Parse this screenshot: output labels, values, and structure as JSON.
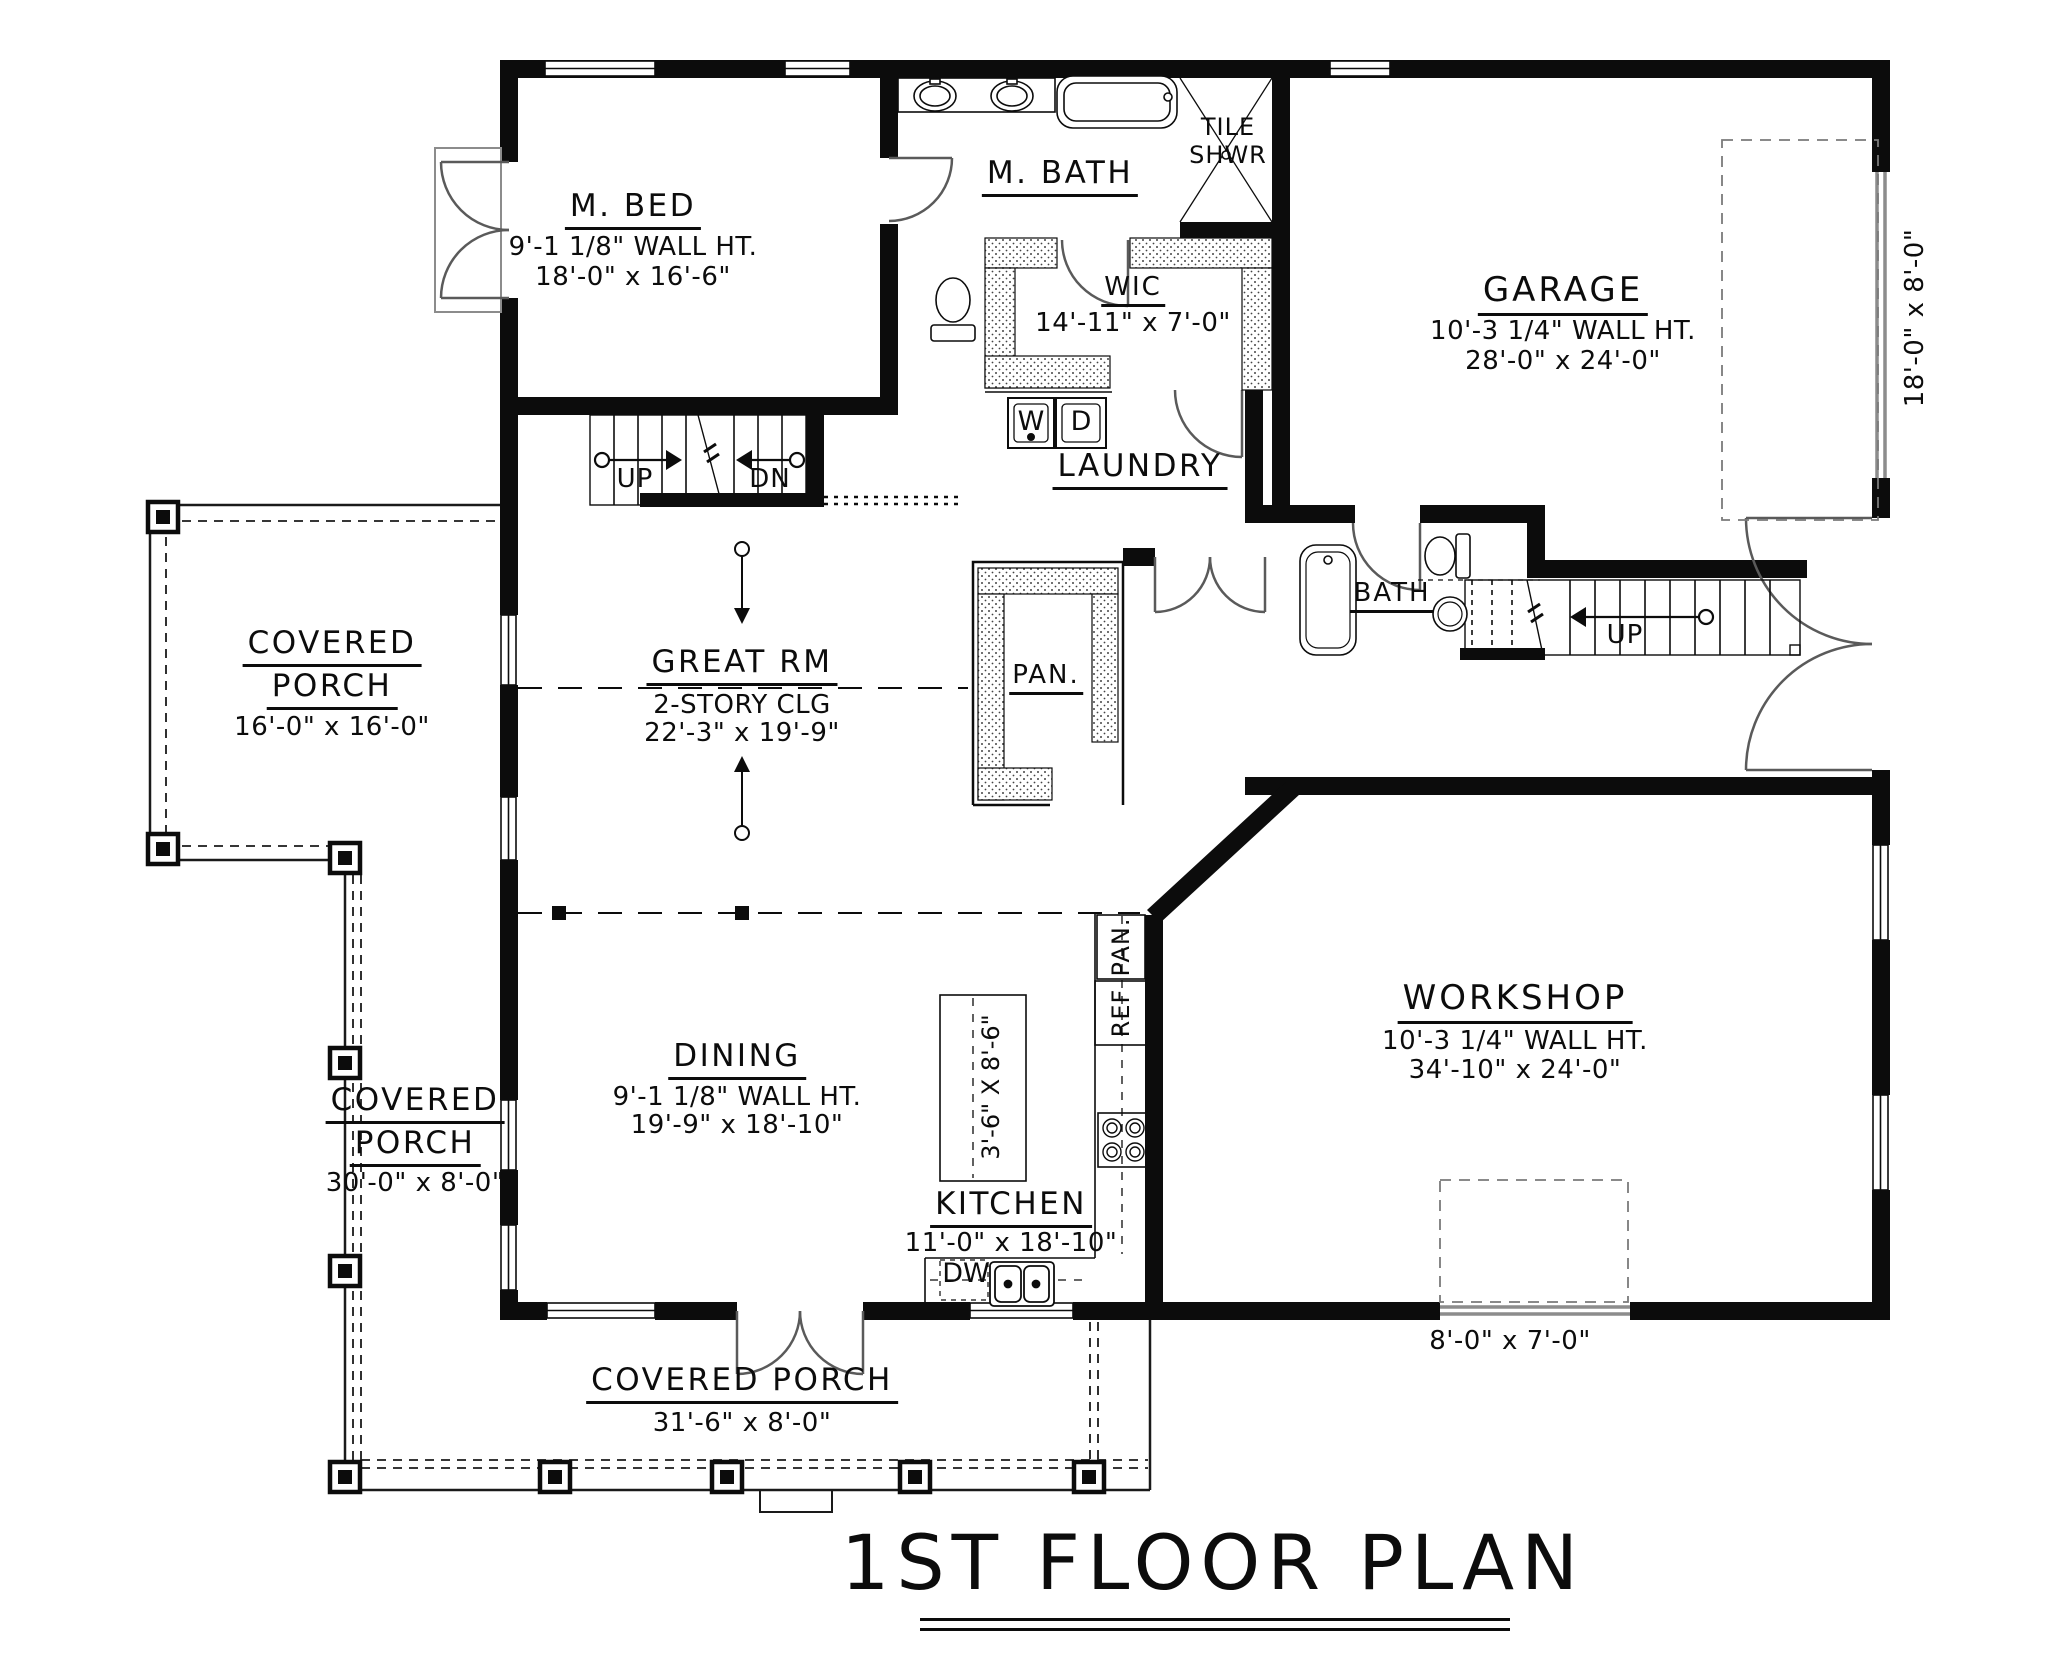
{
  "title": "1ST FLOOR PLAN",
  "rooms": {
    "m_bed": {
      "name": "M. BED",
      "wall_ht": "9'-1 1/8\" WALL HT.",
      "dims": "18'-0\" x 16'-6\""
    },
    "m_bath": {
      "name": "M. BATH"
    },
    "tile_shower": {
      "line1": "TILE",
      "line2": "SHWR"
    },
    "wic": {
      "name": "WIC",
      "dims": "14'-11\" x 7'-0\""
    },
    "garage": {
      "name": "GARAGE",
      "wall_ht": "10'-3 1/4\" WALL HT.",
      "dims": "28'-0\" x 24'-0\"",
      "door_dims": "18'-0\" x 8'-0\""
    },
    "laundry": {
      "name": "LAUNDRY"
    },
    "porch_left": {
      "name1": "COVERED",
      "name2": "PORCH",
      "dims": "16'-0\" x 16'-0\""
    },
    "great_rm": {
      "name": "GREAT RM",
      "ceiling": "2-STORY CLG",
      "dims": "22'-3\" x 19'-9\""
    },
    "pantry": {
      "name": "PAN."
    },
    "bath": {
      "name": "BATH"
    },
    "porch_side": {
      "name1": "COVERED",
      "name2": "PORCH",
      "dims": "30'-0\" x 8'-0\""
    },
    "dining": {
      "name": "DINING",
      "wall_ht": "9'-1 1/8\" WALL HT.",
      "dims": "19'-9\" x 18'-10\""
    },
    "kitchen": {
      "name": "KITCHEN",
      "dims": "11'-0\" x 18'-10\"",
      "island_dims": "3'-6\" X 8'-6\""
    },
    "kitchen_pantry": {
      "name": "PAN."
    },
    "workshop": {
      "name": "WORKSHOP",
      "wall_ht": "10'-3 1/4\" WALL HT.",
      "dims": "34'-10\" x 24'-0\"",
      "door_dims": "8'-0\" x 7'-0\""
    },
    "porch_bottom": {
      "name": "COVERED PORCH",
      "dims": "31'-6\" x 8'-0\""
    }
  },
  "stairs": {
    "center_up": "UP",
    "center_dn": "DN",
    "right_up": "UP"
  },
  "appliances": {
    "washer": "W",
    "dryer": "D",
    "dishwasher": "DW",
    "refrigerator": "REF"
  }
}
